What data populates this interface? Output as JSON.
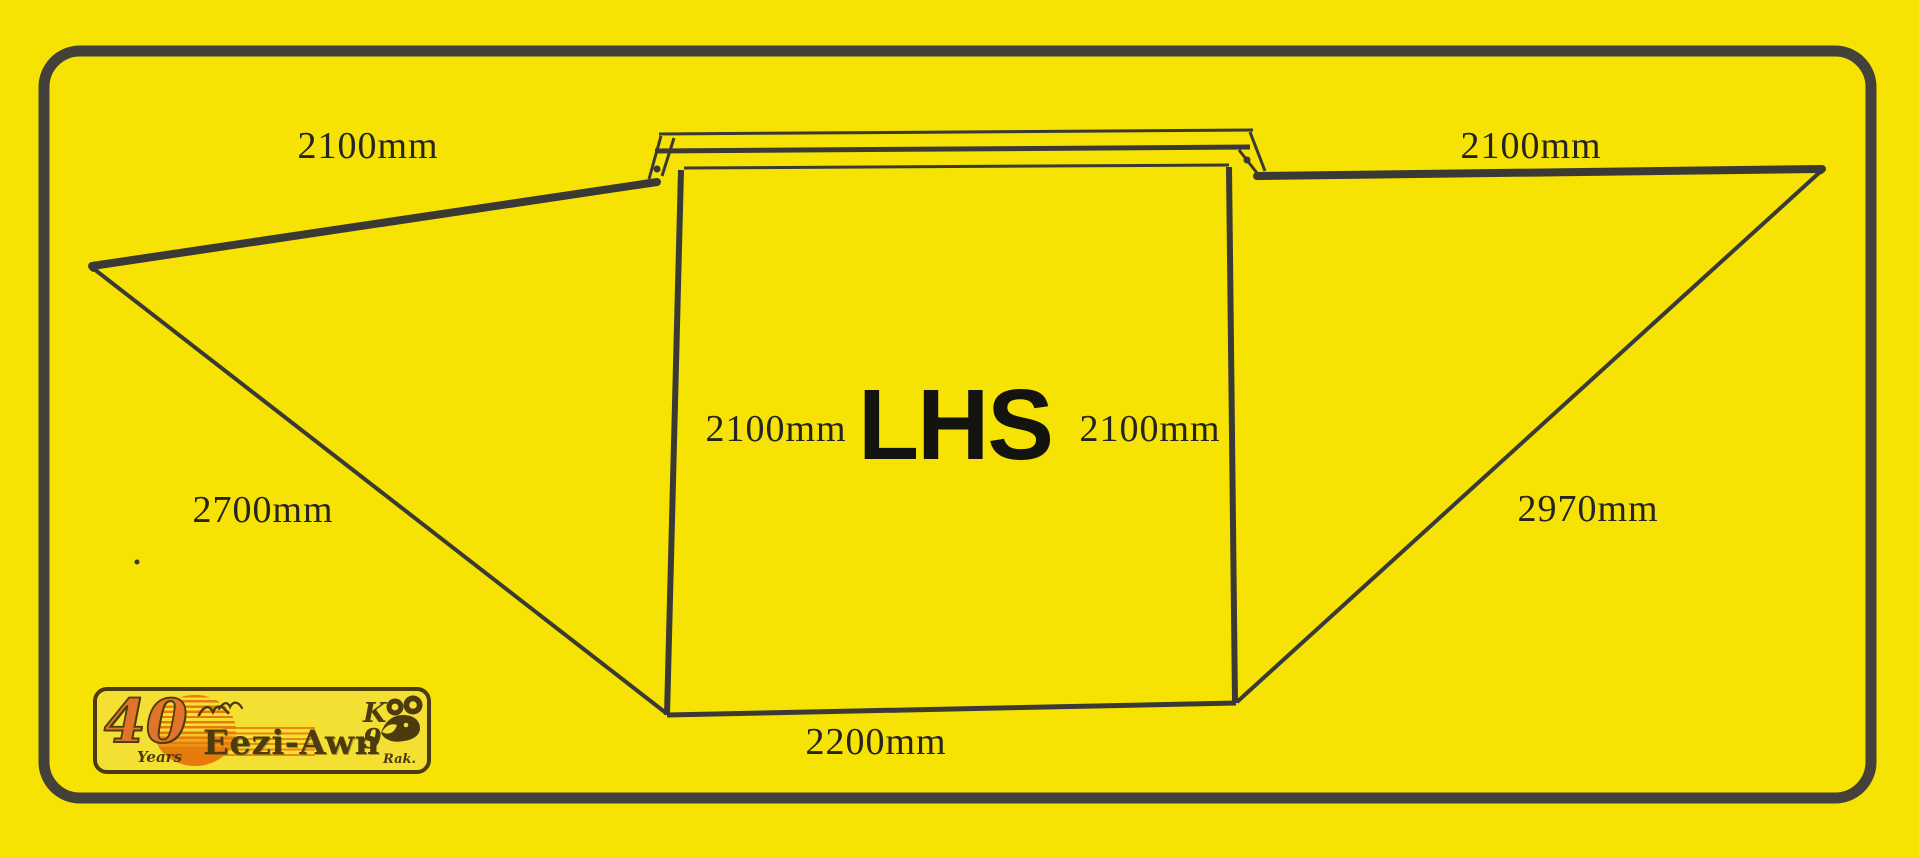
{
  "diagram": {
    "panel_label": "LHS",
    "dimensions": {
      "left_wing_top": "2100mm",
      "right_wing_top": "2100mm",
      "left_wing_slant": "2700mm",
      "right_wing_slant": "2970mm",
      "panel_bottom": "2200mm",
      "panel_left_side": "2100mm",
      "panel_right_side": "2100mm"
    }
  },
  "logo": {
    "anniversary_number": "40",
    "anniversary_word": "Years",
    "brand": "Eezi-Awn",
    "k9": "K9",
    "rak": "Rak."
  },
  "colors": {
    "bg": "#f7e303",
    "ink": "#3b3933",
    "border": "#44413b",
    "brown": "#4d3b10",
    "orange": "#e2732a",
    "sun": "#e8790c"
  }
}
